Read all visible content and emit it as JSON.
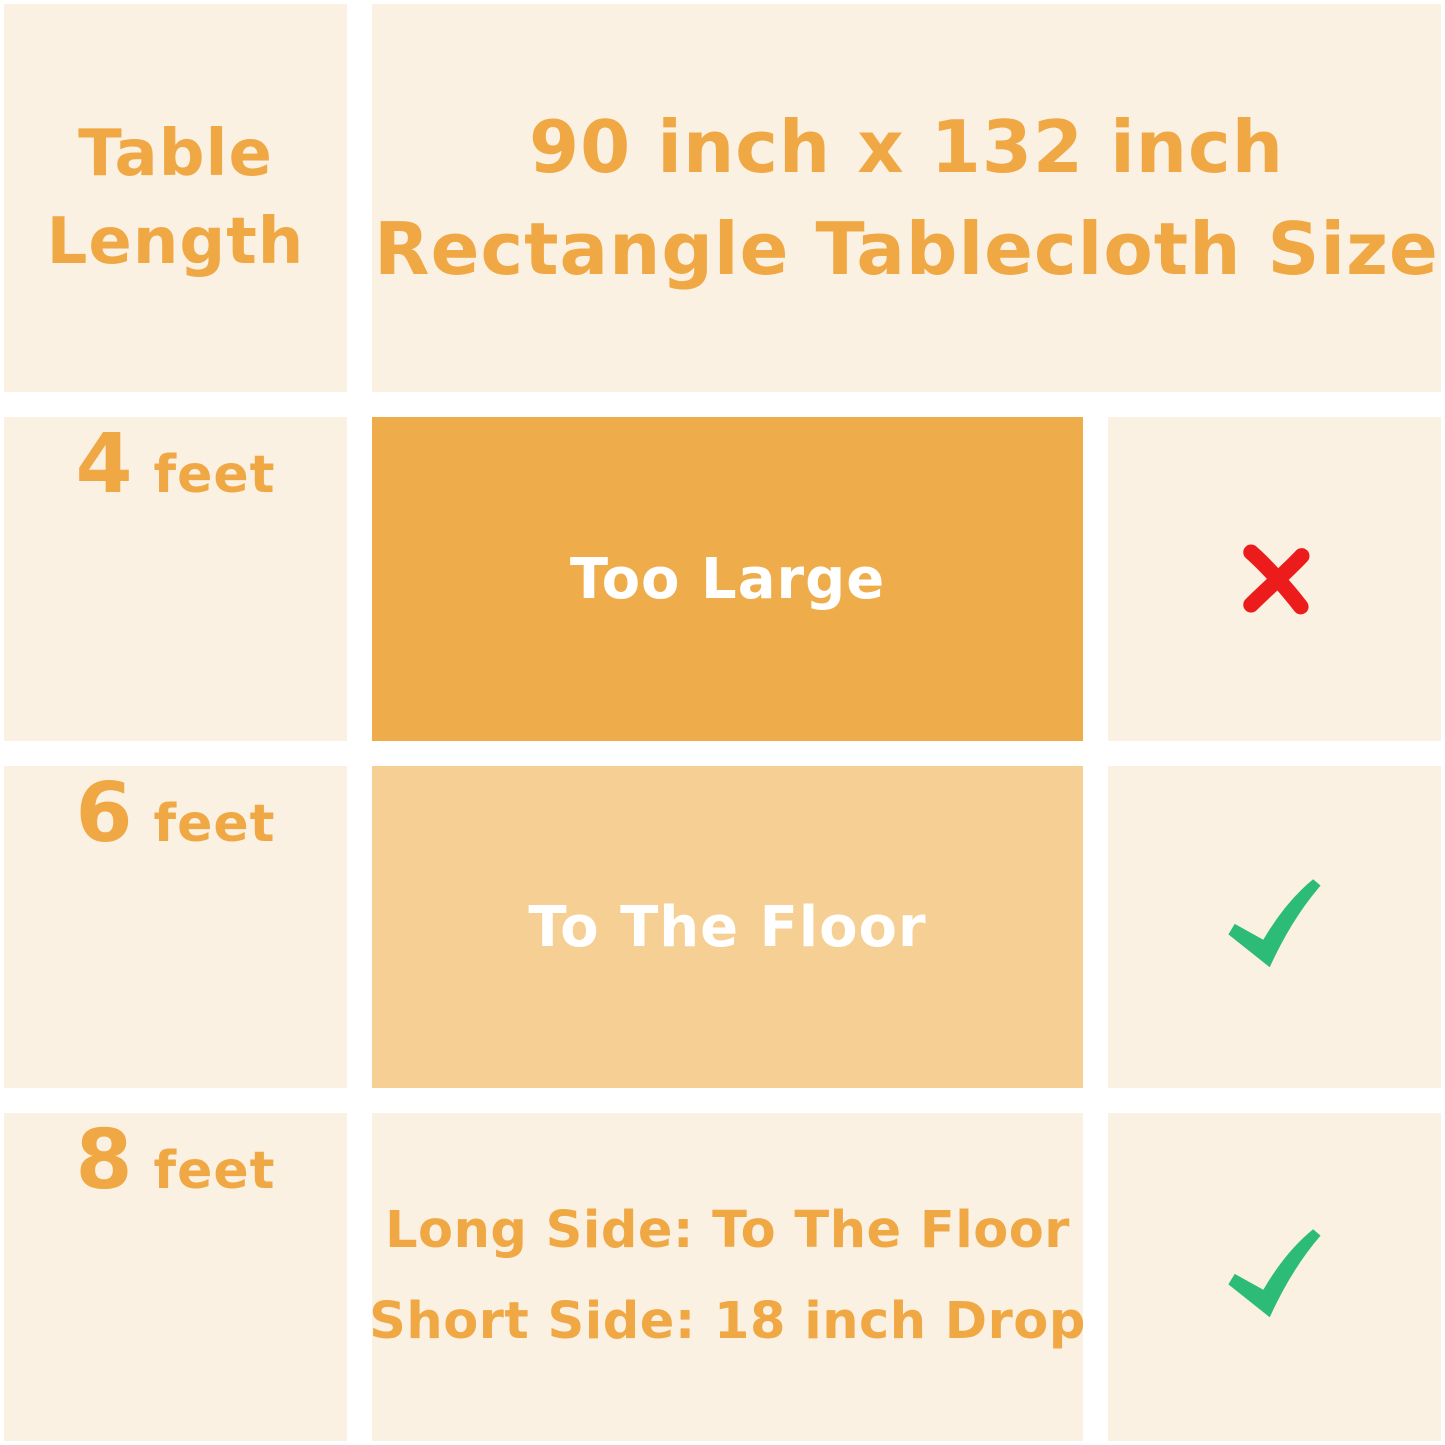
{
  "colors": {
    "page_gutter": "#FFFFFF",
    "cell_cream": "#FAF1E2",
    "text_orange": "#F0A845",
    "box_dark_orange": "#EFAC4B",
    "box_light_orange": "#F5CF93",
    "box_text_white": "#FFFFFF",
    "check_green": "#2DBC78",
    "cross_red": "#ED1C1C"
  },
  "header": {
    "row_label_line1": "Table",
    "row_label_line2": "Length",
    "size_title_line1": "90 inch x 132 inch",
    "size_title_line2": "Rectangle Tablecloth Size"
  },
  "rows": [
    {
      "length_number": "4",
      "length_unit": "feet",
      "fit_text": "Too Large",
      "verdict": "not-suitable"
    },
    {
      "length_number": "6",
      "length_unit": "feet",
      "fit_text": "To The Floor",
      "verdict": "suitable"
    },
    {
      "length_number": "8",
      "length_unit": "feet",
      "fit_text_line1": "Long Side: To The Floor",
      "fit_text_line2": "Short Side: 18 inch Drop",
      "verdict": "suitable"
    }
  ],
  "chart_data": {
    "type": "table",
    "title": "90 inch x 132 inch Rectangle Tablecloth Size",
    "columns": [
      "Table Length",
      "90 inch x 132 inch Rectangle Tablecloth Size",
      "Fit Verdict"
    ],
    "rows": [
      [
        "4 feet",
        "Too Large",
        "✗"
      ],
      [
        "6 feet",
        "To The Floor",
        "✓"
      ],
      [
        "8 feet",
        "Long Side: To The Floor / Short Side: 18 inch Drop",
        "✓"
      ]
    ],
    "legend": {
      "✓": "fits",
      "✗": "does not fit"
    },
    "layout": "3 data rows, header row spans fit and verdict columns"
  }
}
